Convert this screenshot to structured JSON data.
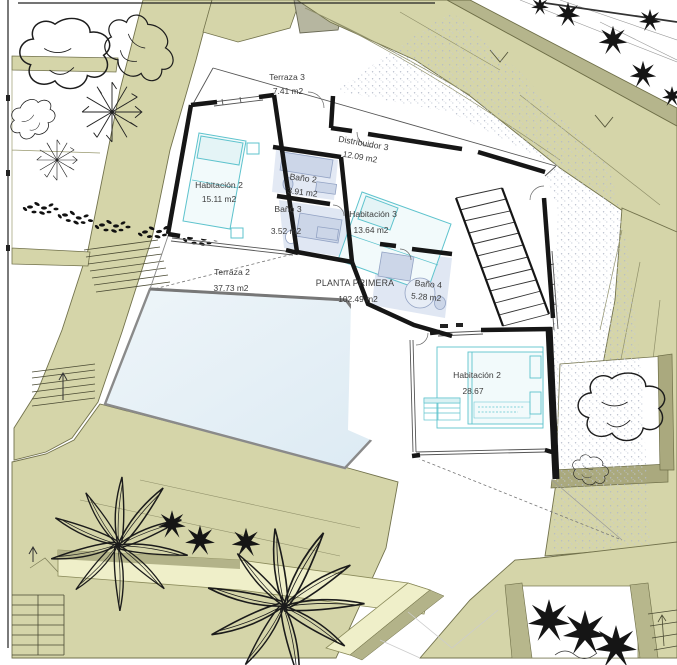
{
  "plan": {
    "drawing_type": "site-floor-plan",
    "floor_title": "PLANTA PRIMERA",
    "floor_area": "102.49 m2",
    "rooms": [
      {
        "name": "Terraza 3",
        "area": "7.41 m2"
      },
      {
        "name": "Distribuidor 3",
        "area": "12.09 m2"
      },
      {
        "name": "Habitación 2",
        "area": "15.11 m2"
      },
      {
        "name": "Baño 2",
        "area": "3.91 m2"
      },
      {
        "name": "Baño 3",
        "area": "3.52 m2"
      },
      {
        "name": "Habitación 3",
        "area": "13.64 m2"
      },
      {
        "name": "Baño 4",
        "area": "5.28 m2"
      },
      {
        "name": "Terraza 2",
        "area": "37.73 m2"
      },
      {
        "name": "Habitación 2",
        "area": "28.67"
      }
    ],
    "colors": {
      "vegetation_zone": "#d5d5a9",
      "path_band": "#b5b58c",
      "planter_light": "#efefc9",
      "pool_water": "#e7f1f6",
      "furniture_cyan": "#5ec3cd",
      "fixture_blue": "#ccd6e8",
      "wall_black": "#161616"
    }
  }
}
